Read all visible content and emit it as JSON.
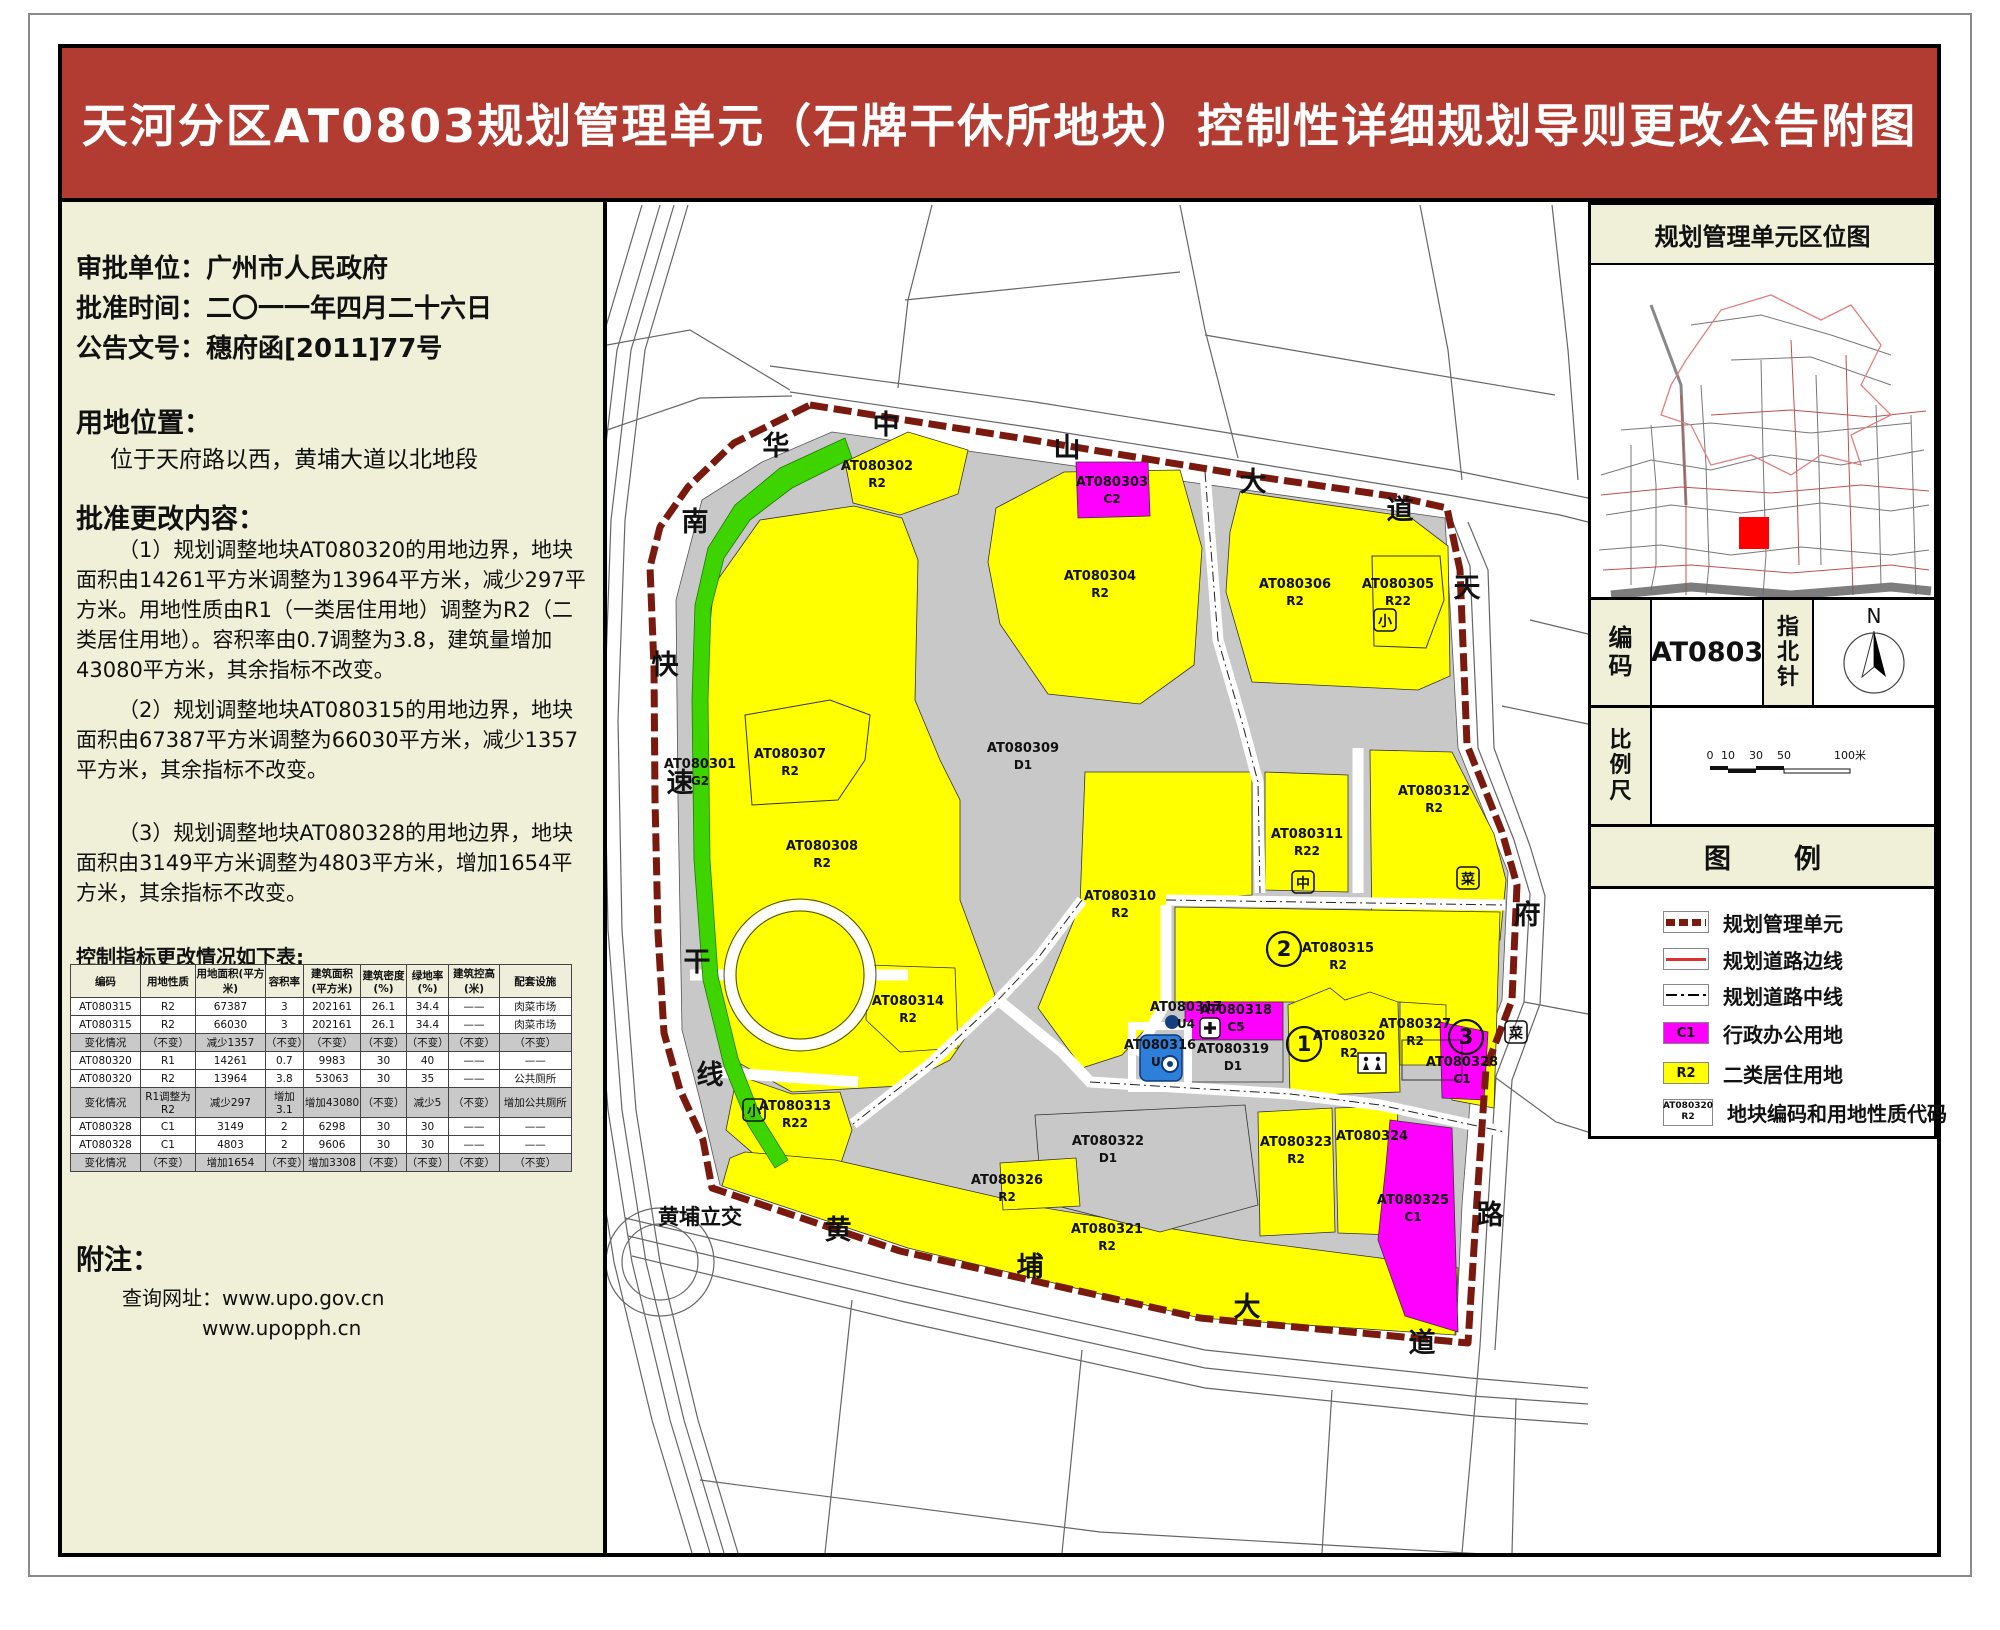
{
  "page": {
    "title": "天河分区AT0803规划管理单元（石牌干休所地块）控制性详细规划导则更改公告附图"
  },
  "colors": {
    "header_red": "#b23c32",
    "panel_beige": "#f0efd8",
    "r2_yellow": "#ffff00",
    "c1_magenta": "#ff00ff",
    "g2_green": "#3ed400",
    "d1_gray": "#c8c8c8",
    "u_blue": "#2e7fd9",
    "boundary_dark_red": "#7a1a0e",
    "road_edge_red": "#e03030"
  },
  "left_panel": {
    "approval_lines": [
      "审批单位：广州市人民政府",
      "批准时间：二〇一一年四月二十六日",
      "公告文号：穗府函[2011]77号"
    ],
    "location_heading": "用地位置：",
    "location_text": "位于天府路以西，黄埔大道以北地段",
    "changes_heading": "批准更改内容：",
    "changes_paragraphs": [
      "（1）规划调整地块AT080320的用地边界，地块面积由14261平方米调整为13964平方米，减少297平方米。用地性质由R1（一类居住用地）调整为R2（二类居住用地）。容积率由0.7调整为3.8，建筑量增加43080平方米，其余指标不改变。",
      "（2）规划调整地块AT080315的用地边界，地块面积由67387平方米调整为66030平方米，减少1357平方米，其余指标不改变。",
      "（3）规划调整地块AT080328的用地边界，地块面积由3149平方米调整为4803平方米，增加1654平方米，其余指标不改变。"
    ],
    "table_caption": "控制指标更改情况如下表:",
    "table": {
      "headers": [
        "编码",
        "用地性质",
        "用地面积(平方米)",
        "容积率",
        "建筑面积(平方米)",
        "建筑密度(%)",
        "绿地率(%)",
        "建筑控高(米)",
        "配套设施"
      ],
      "rows": [
        {
          "cells": [
            "AT080315",
            "R2",
            "67387",
            "3",
            "202161",
            "26.1",
            "34.4",
            "——",
            "肉菜市场"
          ],
          "change": false
        },
        {
          "cells": [
            "AT080315",
            "R2",
            "66030",
            "3",
            "202161",
            "26.1",
            "34.4",
            "——",
            "肉菜市场"
          ],
          "change": false
        },
        {
          "cells": [
            "变化情况",
            "（不变）",
            "减少1357",
            "（不变）",
            "（不变）",
            "（不变）",
            "（不变）",
            "（不变）",
            "（不变）"
          ],
          "change": true
        },
        {
          "cells": [
            "AT080320",
            "R1",
            "14261",
            "0.7",
            "9983",
            "30",
            "40",
            "——",
            "——"
          ],
          "change": false
        },
        {
          "cells": [
            "AT080320",
            "R2",
            "13964",
            "3.8",
            "53063",
            "30",
            "35",
            "——",
            "公共厕所"
          ],
          "change": false
        },
        {
          "cells": [
            "变化情况",
            "R1调整为R2",
            "减少297",
            "增加3.1",
            "增加43080",
            "（不变）",
            "减少5",
            "（不变）",
            "增加公共厕所"
          ],
          "change": true
        },
        {
          "cells": [
            "AT080328",
            "C1",
            "3149",
            "2",
            "6298",
            "30",
            "30",
            "——",
            "——"
          ],
          "change": false
        },
        {
          "cells": [
            "AT080328",
            "C1",
            "4803",
            "2",
            "9606",
            "30",
            "30",
            "——",
            "——"
          ],
          "change": false
        },
        {
          "cells": [
            "变化情况",
            "（不变）",
            "增加1654",
            "（不变）",
            "增加3308",
            "（不变）",
            "（不变）",
            "（不变）",
            "（不变）"
          ],
          "change": true
        }
      ]
    },
    "notes_heading": "附注：",
    "notes_lines": [
      "查询网址：www.upo.gov.cn",
      "www.upopph.cn"
    ]
  },
  "right_panel": {
    "location_map_title": "规划管理单元区位图",
    "code_label": "编码",
    "code_value": "AT0803",
    "compass_label": "指北针",
    "compass_north": "N",
    "scale_label": "比例尺",
    "scale_ticks": [
      "0",
      "10",
      "30",
      "50"
    ],
    "scale_end": "100米",
    "legend_title": "图　例",
    "legend_items": [
      {
        "swatch": "unit-boundary",
        "label": "规划管理单元"
      },
      {
        "swatch": "road-edge",
        "label": "规划道路边线"
      },
      {
        "swatch": "road-center",
        "label": "规划道路中线"
      },
      {
        "swatch": "c1",
        "code": "C1",
        "label": "行政办公用地"
      },
      {
        "swatch": "r2",
        "code": "R2",
        "label": "二类居住用地"
      },
      {
        "swatch": "parcel-code",
        "code": "AT080320",
        "code2": "R2",
        "label": "地块编码和用地性质代码"
      }
    ]
  },
  "map": {
    "parcel_labels": [
      {
        "code": "AT080301",
        "sub": "G2",
        "x": 700,
        "y": 768
      },
      {
        "code": "AT080302",
        "sub": "R2",
        "x": 877,
        "y": 470
      },
      {
        "code": "AT080303",
        "sub": "C2",
        "x": 1112,
        "y": 486
      },
      {
        "code": "AT080304",
        "sub": "R2",
        "x": 1100,
        "y": 580
      },
      {
        "code": "AT080306",
        "sub": "R2",
        "x": 1295,
        "y": 588
      },
      {
        "code": "AT080305",
        "sub": "R22",
        "x": 1398,
        "y": 588
      },
      {
        "code": "AT080307",
        "sub": "R2",
        "x": 790,
        "y": 758
      },
      {
        "code": "AT080308",
        "sub": "R2",
        "x": 822,
        "y": 850
      },
      {
        "code": "AT080309",
        "sub": "D1",
        "x": 1023,
        "y": 752
      },
      {
        "code": "AT080310",
        "sub": "R2",
        "x": 1120,
        "y": 900
      },
      {
        "code": "AT080311",
        "sub": "R22",
        "x": 1307,
        "y": 838
      },
      {
        "code": "AT080312",
        "sub": "R2",
        "x": 1434,
        "y": 795
      },
      {
        "code": "AT080313",
        "sub": "R22",
        "x": 795,
        "y": 1110
      },
      {
        "code": "AT080314",
        "sub": "R2",
        "x": 908,
        "y": 1005
      },
      {
        "code": "AT080315",
        "sub": "R2",
        "x": 1338,
        "y": 952
      },
      {
        "code": "AT080316",
        "sub": "U1",
        "x": 1160,
        "y": 1049
      },
      {
        "code": "AT080317",
        "sub": "U4",
        "x": 1186,
        "y": 1011
      },
      {
        "code": "AT080318",
        "sub": "C5",
        "x": 1236,
        "y": 1014
      },
      {
        "code": "AT080319",
        "sub": "D1",
        "x": 1233,
        "y": 1053
      },
      {
        "code": "AT080320",
        "sub": "R2",
        "x": 1349,
        "y": 1040
      },
      {
        "code": "AT080321",
        "sub": "R2",
        "x": 1107,
        "y": 1233
      },
      {
        "code": "AT080322",
        "sub": "D1",
        "x": 1108,
        "y": 1145
      },
      {
        "code": "AT080323",
        "sub": "R2",
        "x": 1296,
        "y": 1146
      },
      {
        "code": "AT080324",
        "sub": "",
        "x": 1372,
        "y": 1140
      },
      {
        "code": "AT080325",
        "sub": "C1",
        "x": 1413,
        "y": 1204
      },
      {
        "code": "AT080326",
        "sub": "R2",
        "x": 1007,
        "y": 1184
      },
      {
        "code": "AT080327",
        "sub": "R2",
        "x": 1415,
        "y": 1028
      },
      {
        "code": "AT080328",
        "sub": "C1",
        "x": 1462,
        "y": 1066
      }
    ],
    "road_labels": [
      {
        "t": "中",
        "x": 886,
        "y": 434
      },
      {
        "t": "山",
        "x": 1067,
        "y": 457
      },
      {
        "t": "大",
        "x": 1253,
        "y": 491
      },
      {
        "t": "道",
        "x": 1400,
        "y": 519
      },
      {
        "t": "华",
        "x": 776,
        "y": 455
      },
      {
        "t": "南",
        "x": 695,
        "y": 531
      },
      {
        "t": "快",
        "x": 665,
        "y": 674
      },
      {
        "t": "速",
        "x": 680,
        "y": 792
      },
      {
        "t": "干",
        "x": 697,
        "y": 971
      },
      {
        "t": "线",
        "x": 710,
        "y": 1084
      },
      {
        "t": "天",
        "x": 1467,
        "y": 597
      },
      {
        "t": "府",
        "x": 1527,
        "y": 924
      },
      {
        "t": "路",
        "x": 1490,
        "y": 1224
      },
      {
        "t": "黄",
        "x": 838,
        "y": 1239
      },
      {
        "t": "埔",
        "x": 1030,
        "y": 1276
      },
      {
        "t": "大",
        "x": 1247,
        "y": 1316
      },
      {
        "t": "道",
        "x": 1422,
        "y": 1352
      }
    ],
    "special_labels": [
      {
        "t": "黄埔立交",
        "x": 700,
        "y": 1224
      }
    ],
    "circled_numbers": [
      {
        "n": "1",
        "x": 1304,
        "y": 1051
      },
      {
        "n": "2",
        "x": 1284,
        "y": 956
      },
      {
        "n": "3",
        "x": 1466,
        "y": 1044
      }
    ],
    "facility_boxed": [
      {
        "t": "小",
        "x": 1385,
        "y": 620
      },
      {
        "t": "小",
        "x": 754,
        "y": 1110
      },
      {
        "t": "中",
        "x": 1303,
        "y": 882
      },
      {
        "t": "菜",
        "x": 1468,
        "y": 878
      },
      {
        "t": "菜",
        "x": 1516,
        "y": 1032
      }
    ],
    "wc_icon": {
      "x": 1372,
      "y": 1063
    },
    "cross_icon": {
      "x": 1210,
      "y": 1028
    },
    "u1_icon": {
      "x": 1170,
      "y": 1064
    },
    "u4_icon": {
      "x": 1170,
      "y": 1022
    }
  }
}
